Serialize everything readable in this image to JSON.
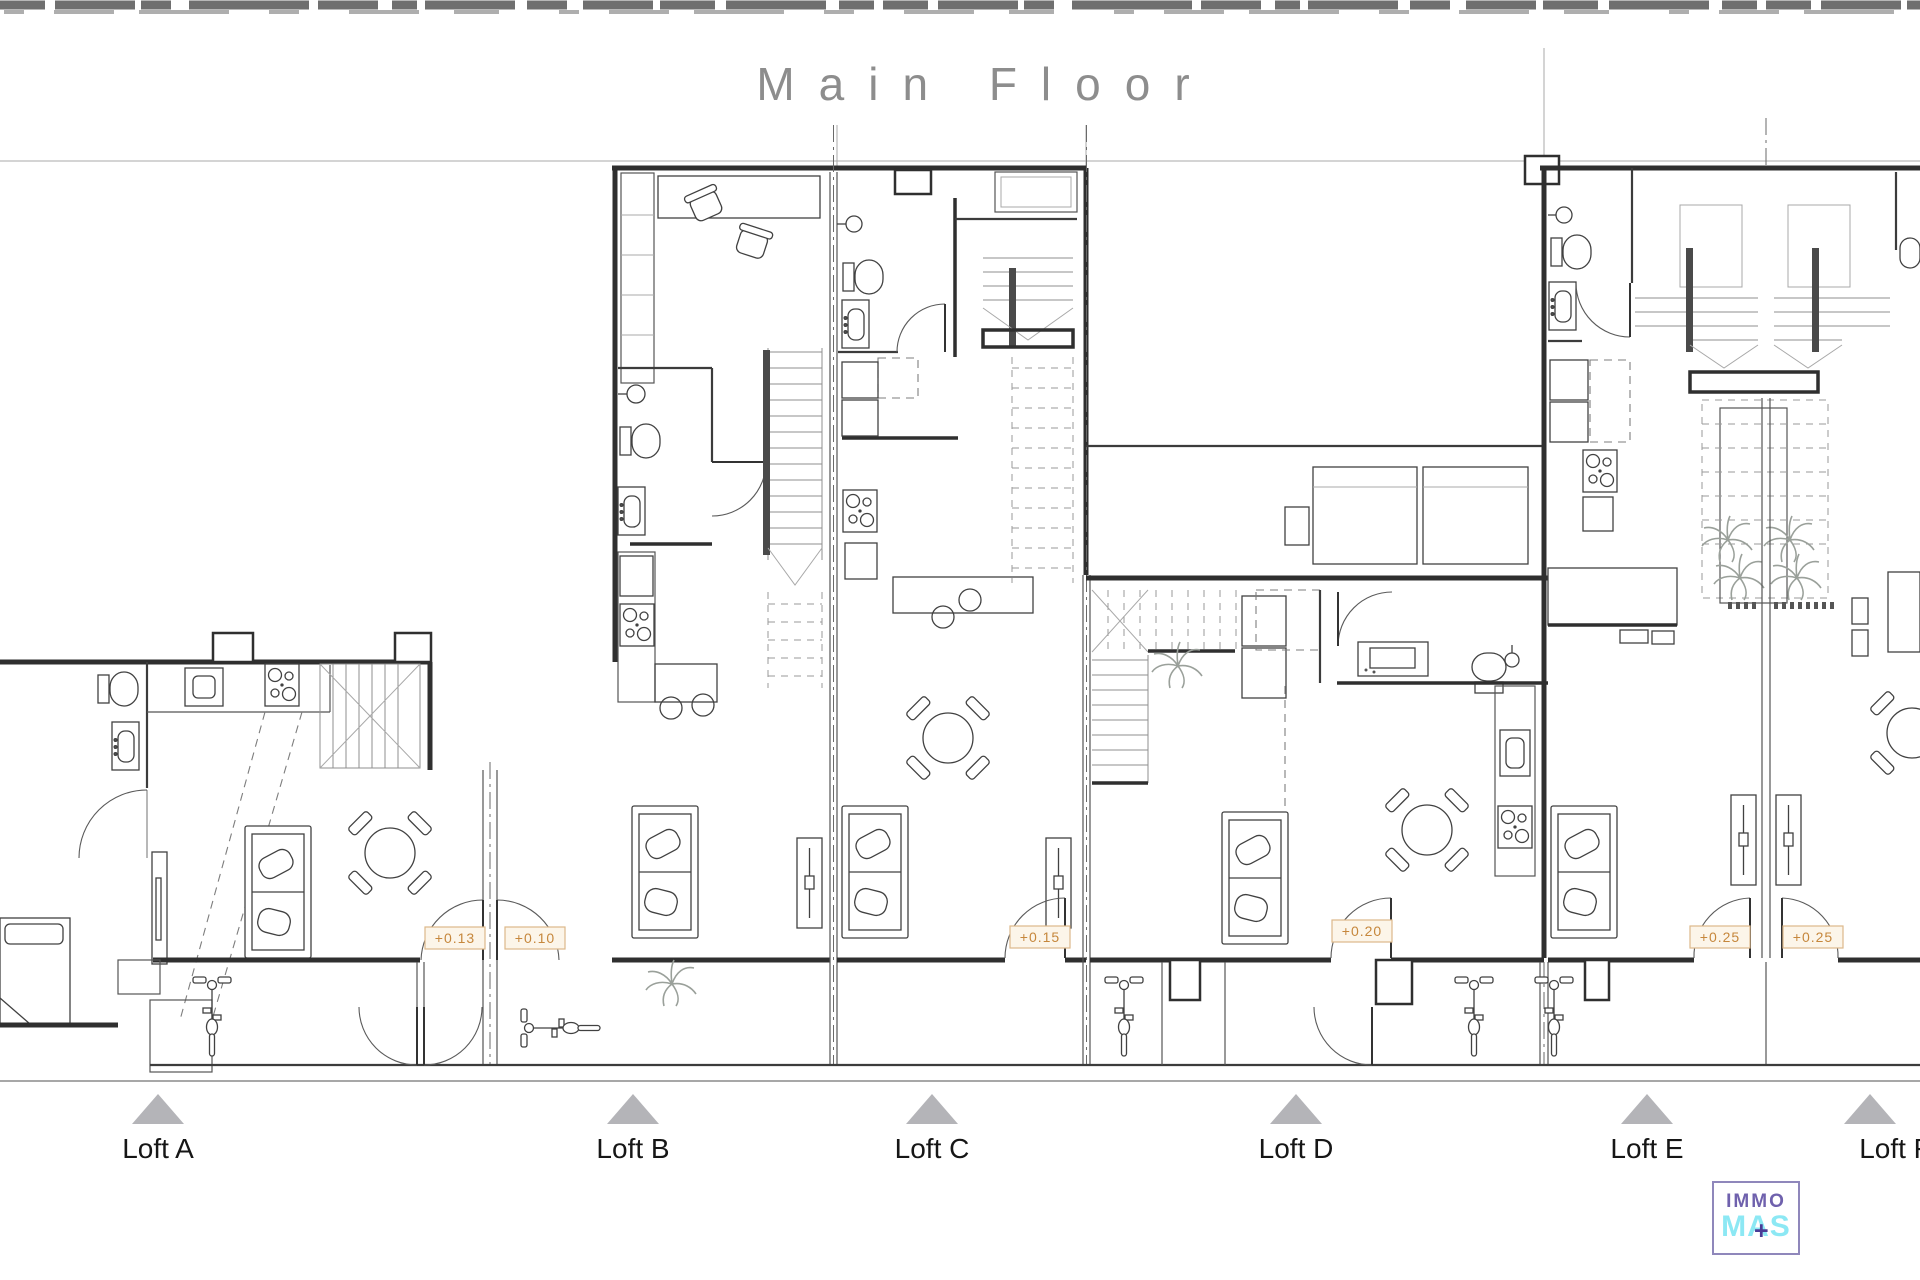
{
  "title": "Main Floor",
  "lofts": [
    {
      "label": "Loft A"
    },
    {
      "label": "Loft B"
    },
    {
      "label": "Loft C"
    },
    {
      "label": "Loft D"
    },
    {
      "label": "Loft E"
    },
    {
      "label": "Loft F"
    }
  ],
  "elevations": [
    {
      "label": "+0.13"
    },
    {
      "label": "+0.10"
    },
    {
      "label": "+0.15"
    },
    {
      "label": "+0.20"
    },
    {
      "label": "+0.25"
    },
    {
      "label": "+0.25"
    }
  ],
  "logo": {
    "line1": "IMMO",
    "line2": "MAS",
    "plus": "+"
  },
  "colors": {
    "marker_triangle": "#b4b4b8",
    "tag_text": "#c6873c",
    "tag_border": "#ddb88a",
    "title_gray": "#8d8d8d",
    "logo_purple": "#6f61ad",
    "logo_cyan": "#8ce8f4",
    "logo_plus_purple": "#4a3c96",
    "line_dark": "#2f2f2f"
  }
}
